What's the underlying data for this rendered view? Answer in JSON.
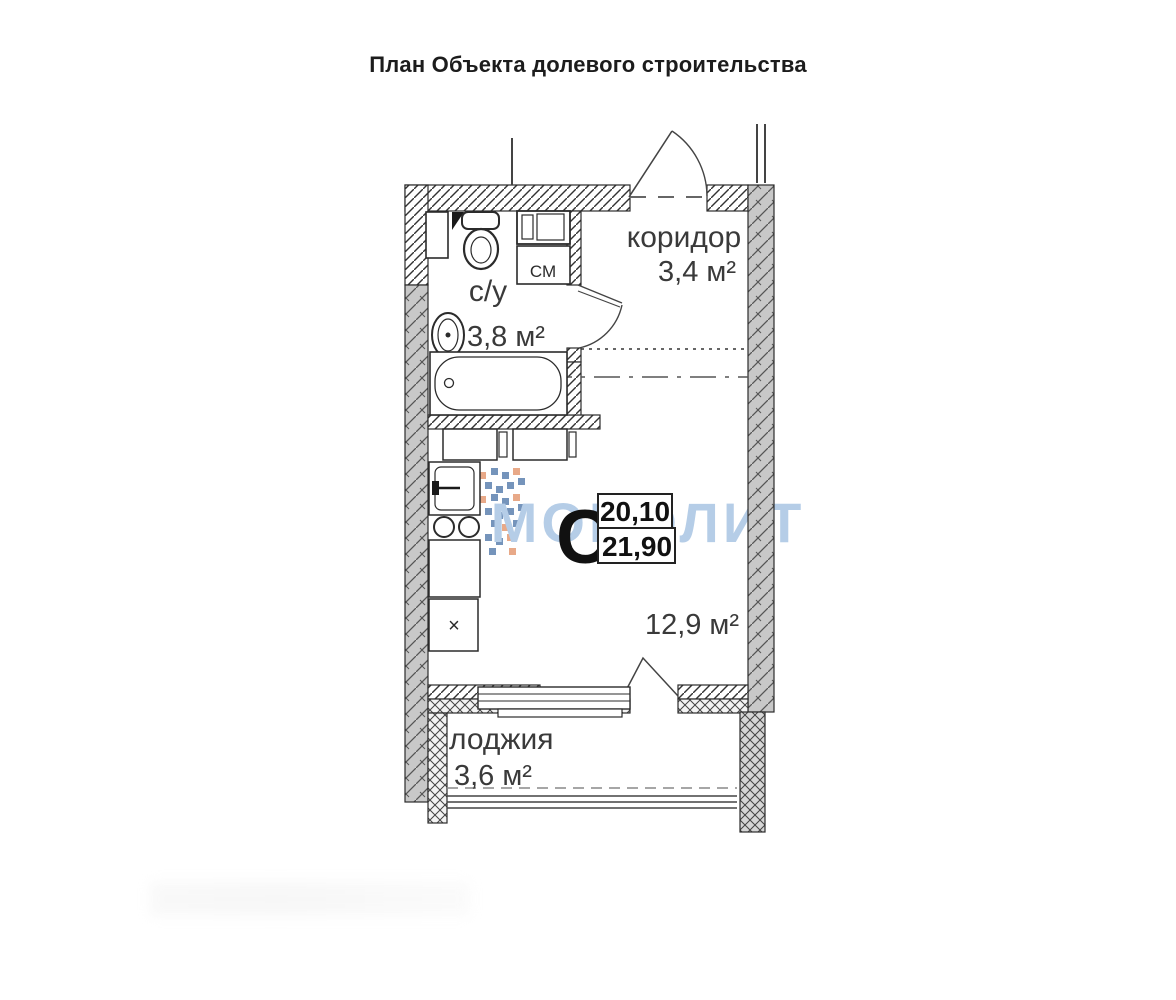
{
  "title": "План Объекта долевого строительства",
  "rooms": {
    "corridor": {
      "label": "коридор",
      "area": "3,4 м²"
    },
    "bathroom": {
      "label": "с/у",
      "area": "3,8 м²"
    },
    "living": {
      "area": "12,9 м²"
    },
    "loggia": {
      "label": "лоджия",
      "area": "3,6 м²"
    }
  },
  "unit": {
    "type_mark": "С",
    "area_value_top": "20,10",
    "area_value_bottom": "21,90"
  },
  "appliances": {
    "washing_machine_label": "СМ",
    "cabinet_mark": "×"
  },
  "watermark": {
    "text": "МОНОЛИТ",
    "color": "#a9c5e3"
  },
  "colors": {
    "wall-grey": "#c8c8c8",
    "line-dark": "#2b2b2b",
    "label-color": "#3a3a3a",
    "logo-blue": "#5d82b0",
    "logo-orange": "#e59b74"
  }
}
